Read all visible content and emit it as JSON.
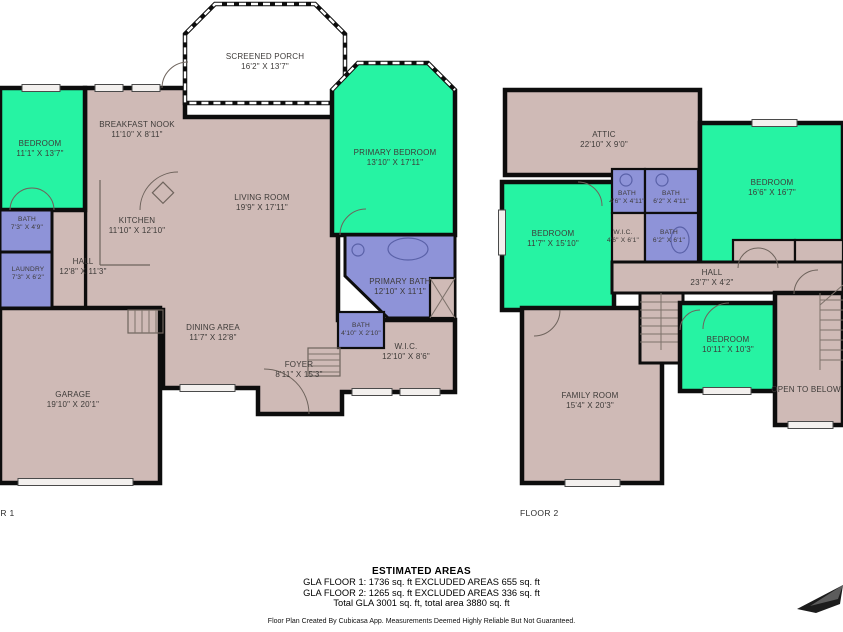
{
  "colors": {
    "bedroom_fill": "#26f3a3",
    "bath_fill": "#8e93d8",
    "floor_fill": "#cfbab6",
    "porch_fill": "#ffffff",
    "wall": "#0d0d0d",
    "label_text": "#3d3a38"
  },
  "floors": [
    {
      "label": "FLOOR 1",
      "rooms": [
        {
          "name": "SCREENED PORCH",
          "dims": "16'2\" X 13'7\""
        },
        {
          "name": "BEDROOM",
          "dims": "11'1\" X 13'7\""
        },
        {
          "name": "BREAKFAST NOOK",
          "dims": "11'10\" X 8'11\""
        },
        {
          "name": "PRIMARY BEDROOM",
          "dims": "13'10\" X 17'11\""
        },
        {
          "name": "BATH",
          "dims": "7'3\" X 4'9\""
        },
        {
          "name": "KITCHEN",
          "dims": "11'10\" X 12'10\""
        },
        {
          "name": "LIVING ROOM",
          "dims": "19'9\" X 17'11\""
        },
        {
          "name": "LAUNDRY",
          "dims": "7'3\" X 6'2\""
        },
        {
          "name": "HALL",
          "dims": "12'8\" X 11'3\""
        },
        {
          "name": "PRIMARY BATH",
          "dims": "12'10\" X 11'1\""
        },
        {
          "name": "BATH",
          "dims": "4'10\" X 2'10\""
        },
        {
          "name": "W.I.C.",
          "dims": "12'10\" X 8'6\""
        },
        {
          "name": "DINING AREA",
          "dims": "11'7\" X 12'8\""
        },
        {
          "name": "FOYER",
          "dims": "8'11\" X 15'3\""
        },
        {
          "name": "GARAGE",
          "dims": "19'10\" X 20'1\""
        }
      ]
    },
    {
      "label": "FLOOR 2",
      "rooms": [
        {
          "name": "ATTIC",
          "dims": "22'10\" X 9'0\""
        },
        {
          "name": "BEDROOM",
          "dims": "11'7\" X 15'10\""
        },
        {
          "name": "BATH",
          "dims": "4'6\" X 4'11\""
        },
        {
          "name": "BATH",
          "dims": "6'2\" X 4'11\""
        },
        {
          "name": "W.I.C.",
          "dims": "4'6\" X 6'1\""
        },
        {
          "name": "BATH",
          "dims": "6'2\" X 6'1\""
        },
        {
          "name": "BEDROOM",
          "dims": "16'6\" X 16'7\""
        },
        {
          "name": "HALL",
          "dims": "23'7\" X 4'2\""
        },
        {
          "name": "FAMILY ROOM",
          "dims": "15'4\" X 20'3\""
        },
        {
          "name": "BEDROOM",
          "dims": "10'11\" X 10'3\""
        },
        {
          "name": "OPEN TO BELOW",
          "dims": ""
        }
      ]
    }
  ],
  "footer": {
    "title": "ESTIMATED AREAS",
    "line1": "GLA FLOOR 1: 1736 sq. ft EXCLUDED AREAS 655 sq. ft",
    "line2": "GLA FLOOR 2: 1265 sq. ft EXCLUDED AREAS 336 sq. ft",
    "line3": "Total GLA 3001 sq. ft, total area 3880 sq. ft",
    "disclaimer": "Floor Plan Created By Cubicasa App. Measurements Deemed Highly Reliable But Not Guaranteed."
  }
}
